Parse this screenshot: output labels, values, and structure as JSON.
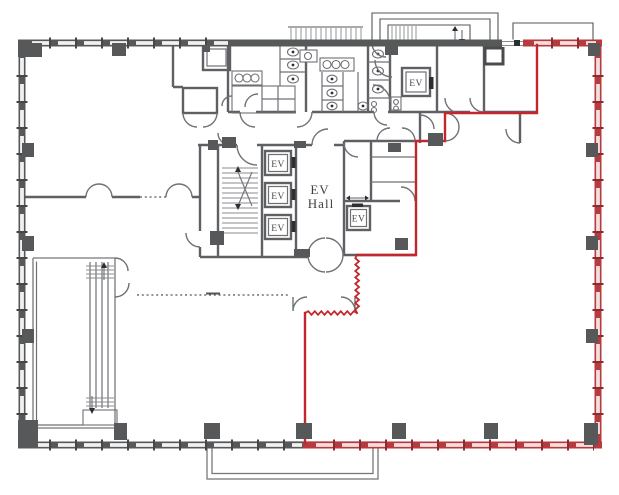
{
  "document": {
    "type": "architectural-floor-plan",
    "labels": {
      "elevator_hall": {
        "line1": "EV",
        "line2": "Hall"
      },
      "elevators": [
        "EV",
        "EV",
        "EV",
        "EV",
        "EV"
      ]
    },
    "colors": {
      "lease_boundary_red": "#c1272d",
      "wall_gray": "#57585a",
      "window_light": "#f1f1f1",
      "background": "#ffffff"
    }
  }
}
